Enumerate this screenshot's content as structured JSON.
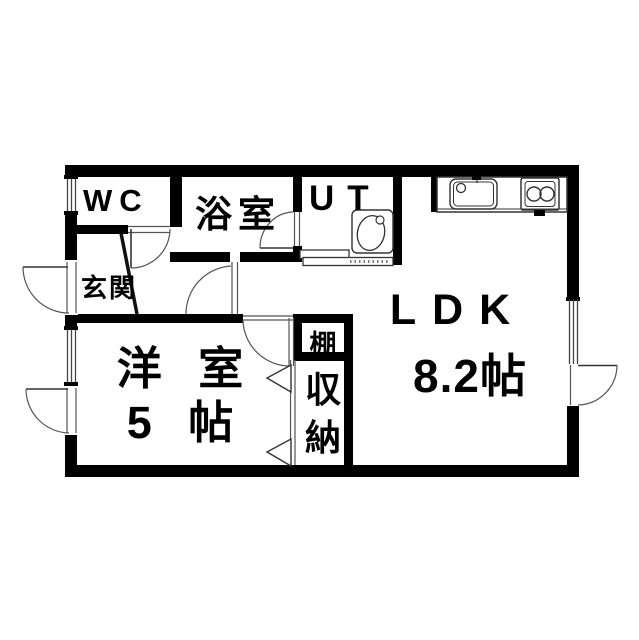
{
  "floor_plan": {
    "wc": "WC",
    "bath": "浴室",
    "utility": "UT",
    "entrance": "玄関",
    "western_room_name": "洋 室",
    "western_room_size": "5 帖",
    "ldk_name": "LDK",
    "ldk_size": "8.2帖",
    "shelf": "棚",
    "closet_char_1": "収",
    "closet_char_2": "納",
    "wall_color": "#000000",
    "line_color": "#444444",
    "background_color": "#ffffff"
  }
}
